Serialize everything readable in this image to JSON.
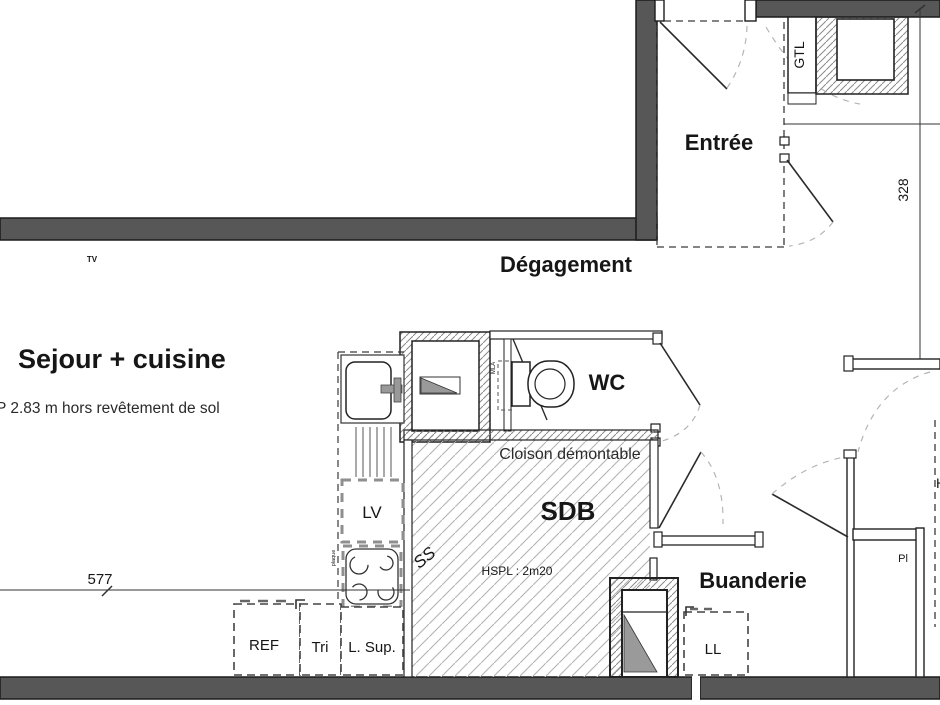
{
  "plan_title": "apartment-floor-plan",
  "colors": {
    "wall": "#575757",
    "fixture_gray": "#9a9a9a",
    "hatch_light": "#b3b3b3",
    "hatch_dense": "#8a8a8a"
  },
  "rooms": {
    "sejour_cuisine": {
      "label": "Sejour + cuisine",
      "note": "P 2.83 m hors revêtement de sol"
    },
    "entree": {
      "label": "Entrée"
    },
    "degagement": {
      "label": "Dégagement"
    },
    "wc": {
      "label": "WC"
    },
    "sdb": {
      "label": "SDB",
      "partition_note": "Cloison démontable",
      "ceiling_note": "HSPL : 2m20",
      "floor_code": "SS"
    },
    "buanderie": {
      "label": "Buanderie"
    }
  },
  "fixtures": {
    "lv": "LV",
    "ref": "REF",
    "tri": "Tri",
    "l_sup": "L. Sup.",
    "ll": "LL",
    "gtl": "GTL",
    "pl": "Pl",
    "tv": "TV",
    "mla": "MLA",
    "plaque": "plaque",
    "h_partial": "H"
  },
  "dimensions": {
    "sejour_width": "577",
    "entree_height": "328"
  }
}
